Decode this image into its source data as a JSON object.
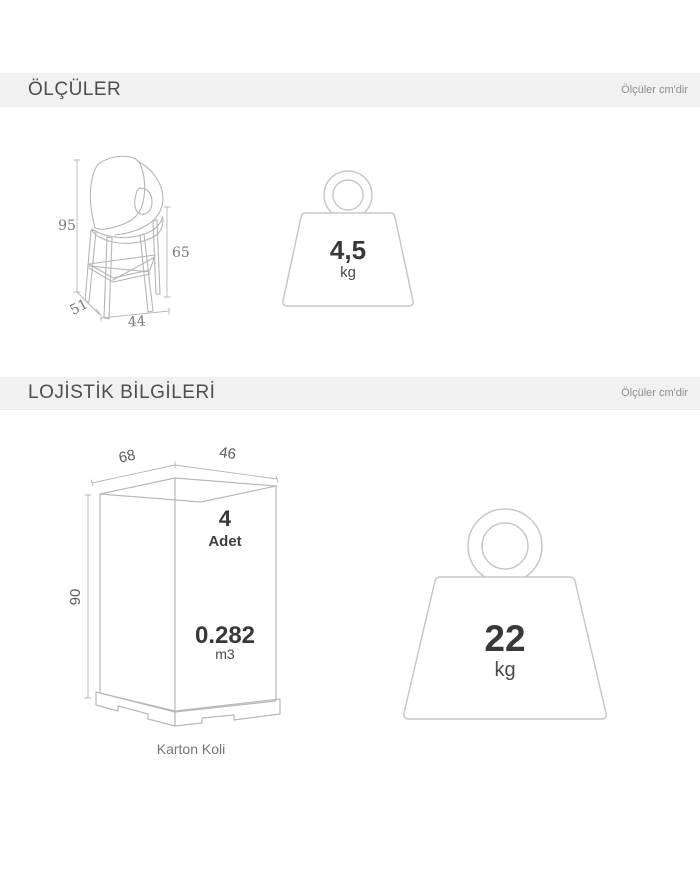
{
  "colors": {
    "header_bg": "#f1f1f1",
    "sketch_line": "#b5b5b5",
    "weight_line": "#c8c8c8",
    "value_text": "#383838"
  },
  "dimensions_section": {
    "title": "ÖLÇÜLER",
    "unit_note": "Ölçüler cm'dir",
    "chair": {
      "height": "95",
      "seat_height": "65",
      "depth": "51",
      "width": "44"
    },
    "weight": {
      "value": "4,5",
      "unit": "kg"
    }
  },
  "logistics_section": {
    "title": "LOJİSTİK BİLGİLERİ",
    "unit_note": "Ölçüler cm'dir",
    "box": {
      "depth": "68",
      "width": "46",
      "height": "90",
      "quantity": "4",
      "quantity_label": "Adet",
      "volume": "0.282",
      "volume_unit": "m3",
      "caption": "Karton Koli"
    },
    "weight": {
      "value": "22",
      "unit": "kg"
    }
  }
}
